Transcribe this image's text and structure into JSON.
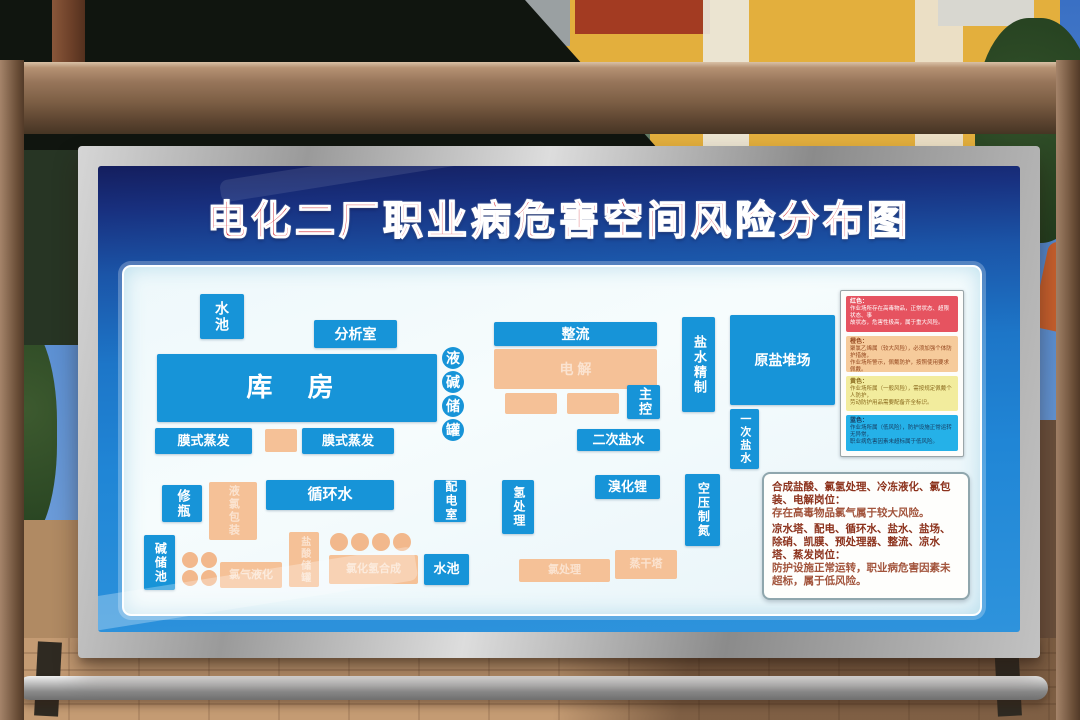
{
  "board": {
    "title": "电化二厂职业病危害空间风险分布图",
    "colors": {
      "title_red": "#cf1e28",
      "blue_box": "#1794d8",
      "orange_box": "#f5c197",
      "poster_blue": "#1d76c8"
    },
    "diagram": {
      "boxes": [
        {
          "id": "shuichi-top",
          "label": "水池",
          "kind": "blue",
          "vertical": true,
          "x": 76,
          "y": 27,
          "w": 44,
          "h": 45,
          "font": 14
        },
        {
          "id": "fenxishi",
          "label": "分析室",
          "kind": "blue",
          "x": 190,
          "y": 53,
          "w": 83,
          "h": 28,
          "font": 14
        },
        {
          "id": "kufang",
          "label": "库 房",
          "kind": "blue",
          "big": true,
          "x": 33,
          "y": 87,
          "w": 280,
          "h": 68,
          "font": 26
        },
        {
          "id": "moshizhengfa-left",
          "label": "膜式蒸发",
          "kind": "blue",
          "x": 31,
          "y": 161,
          "w": 97,
          "h": 26,
          "font": 13
        },
        {
          "id": "orange-mid",
          "label": "",
          "kind": "orange",
          "x": 141,
          "y": 162,
          "w": 32,
          "h": 23,
          "font": 10
        },
        {
          "id": "moshizhengfa-right",
          "label": "膜式蒸发",
          "kind": "blue",
          "x": 178,
          "y": 161,
          "w": 92,
          "h": 26,
          "font": 13
        },
        {
          "id": "xiuping",
          "label": "修瓶",
          "kind": "blue",
          "vertical": true,
          "x": 38,
          "y": 218,
          "w": 40,
          "h": 37,
          "font": 13
        },
        {
          "id": "yelv-baozhuang",
          "label": "液氯包装",
          "kind": "orange",
          "vertical": true,
          "faint": true,
          "x": 85,
          "y": 215,
          "w": 48,
          "h": 58,
          "font": 11
        },
        {
          "id": "xunhuanshui",
          "label": "循环水",
          "kind": "blue",
          "x": 142,
          "y": 213,
          "w": 128,
          "h": 30,
          "font": 15
        },
        {
          "id": "peidianshi",
          "label": "配电室",
          "kind": "blue",
          "vertical": true,
          "x": 310,
          "y": 213,
          "w": 32,
          "h": 42,
          "font": 12
        },
        {
          "id": "jianchuchi",
          "label": "碱储池",
          "kind": "blue",
          "vertical": true,
          "x": 20,
          "y": 268,
          "w": 31,
          "h": 55,
          "font": 12
        },
        {
          "id": "tanks-2x2",
          "label": "",
          "kind": "orange-circles",
          "x": 58,
          "y": 285,
          "w": 60,
          "h": 36,
          "rows": 2,
          "cols": 2,
          "r": 16
        },
        {
          "id": "lvqi-yehua",
          "label": "氯气液化",
          "kind": "orange",
          "faint": true,
          "x": 96,
          "y": 295,
          "w": 62,
          "h": 26,
          "font": 11
        },
        {
          "id": "yansuan-chuguan",
          "label": "盐酸储罐",
          "kind": "orange",
          "vertical": true,
          "faint": true,
          "x": 165,
          "y": 265,
          "w": 30,
          "h": 55,
          "font": 10
        },
        {
          "id": "tanks-row4",
          "label": "",
          "kind": "orange-circles",
          "x": 206,
          "y": 266,
          "w": 88,
          "h": 20,
          "rows": 1,
          "cols": 4,
          "r": 18
        },
        {
          "id": "lvhuaqing-hecheng",
          "label": "氯化氢合成",
          "kind": "orange",
          "faint": true,
          "x": 205,
          "y": 288,
          "w": 89,
          "h": 29,
          "font": 11
        },
        {
          "id": "shuichi-bottom",
          "label": "水池",
          "kind": "blue",
          "x": 300,
          "y": 287,
          "w": 45,
          "h": 31,
          "font": 13
        },
        {
          "id": "yejian-chuguan",
          "label": "液碱储罐",
          "kind": "blue-circles",
          "x": 318,
          "y": 80,
          "w": 26,
          "h": 92,
          "rows": 4,
          "cols": 1,
          "r": 22
        },
        {
          "id": "zhengliu",
          "label": "整流",
          "kind": "blue",
          "x": 370,
          "y": 55,
          "w": 163,
          "h": 24,
          "font": 14
        },
        {
          "id": "dianjie",
          "label": "电 解",
          "kind": "orange",
          "faint": true,
          "x": 370,
          "y": 82,
          "w": 163,
          "h": 40,
          "font": 14
        },
        {
          "id": "orange-a",
          "label": "",
          "kind": "orange",
          "x": 381,
          "y": 126,
          "w": 52,
          "h": 21,
          "font": 10
        },
        {
          "id": "orange-b",
          "label": "",
          "kind": "orange",
          "x": 443,
          "y": 126,
          "w": 52,
          "h": 21,
          "font": 10
        },
        {
          "id": "zhukong",
          "label": "主控",
          "kind": "blue",
          "vertical": true,
          "x": 503,
          "y": 118,
          "w": 33,
          "h": 34,
          "font": 13
        },
        {
          "id": "erci-yanshui",
          "label": "二次盐水",
          "kind": "blue",
          "x": 453,
          "y": 162,
          "w": 83,
          "h": 22,
          "font": 13
        },
        {
          "id": "qingchuli",
          "label": "氢处理",
          "kind": "blue",
          "vertical": true,
          "x": 378,
          "y": 213,
          "w": 32,
          "h": 54,
          "font": 12
        },
        {
          "id": "xiuhuali",
          "label": "溴化锂",
          "kind": "blue",
          "x": 471,
          "y": 208,
          "w": 65,
          "h": 24,
          "font": 13
        },
        {
          "id": "kongya-zhidan",
          "label": "空压制氮",
          "kind": "blue",
          "vertical": true,
          "x": 561,
          "y": 207,
          "w": 35,
          "h": 72,
          "font": 12
        },
        {
          "id": "yici-yanshui",
          "label": "一次盐水",
          "kind": "blue",
          "vertical": true,
          "x": 606,
          "y": 142,
          "w": 29,
          "h": 60,
          "font": 11
        },
        {
          "id": "yanshui-jingzhi",
          "label": "盐水精制",
          "kind": "blue",
          "vertical": true,
          "x": 558,
          "y": 50,
          "w": 33,
          "h": 95,
          "font": 13
        },
        {
          "id": "yuanyan-duichang",
          "label": "原盐堆场",
          "kind": "blue",
          "x": 606,
          "y": 48,
          "w": 105,
          "h": 90,
          "font": 14
        },
        {
          "id": "lvchuli",
          "label": "氯处理",
          "kind": "orange",
          "faint": true,
          "x": 395,
          "y": 292,
          "w": 91,
          "h": 23,
          "font": 11
        },
        {
          "id": "zhengganta",
          "label": "蒸干塔",
          "kind": "orange",
          "faint": true,
          "x": 491,
          "y": 283,
          "w": 62,
          "h": 29,
          "font": 11
        }
      ]
    },
    "legend": {
      "strips": [
        {
          "name": "red",
          "color": "#e65360",
          "text_color": "#ffffff",
          "title": "红色：",
          "lines": [
            "作业场所存在高毒物品，正常状态、超限状态、事",
            "故状态，危害性极高，属于重大风险。"
          ]
        },
        {
          "name": "orange",
          "color": "#f6cb9b",
          "text_color": "#94461e",
          "title": "橙色：",
          "lines": [
            "聚氯乙烯属（较大风险），必须加强个体防护措施，",
            "作业场所警示，佩戴防护，按照使用要求佩戴。"
          ]
        },
        {
          "name": "yellow",
          "color": "#f2ec9d",
          "text_color": "#8a6a1e",
          "title": "黄色：",
          "lines": [
            "作业场所属（一般风险），需按规定佩戴个人防护，",
            "劳动防护用品需要配备齐全标识。"
          ]
        },
        {
          "name": "blue",
          "color": "#25b1e8",
          "text_color": "#173a5e",
          "title": "蓝色：",
          "lines": [
            "作业场所属（低风险），防护设施正常运转无异常，",
            "职业病危害因素未超标属于低风险。"
          ]
        }
      ]
    },
    "info": {
      "sections": [
        {
          "head": "合成盐酸、氯氢处理、冷冻液化、氯包装、电解岗位：",
          "body": "存在高毒物品氯气属于较大风险。"
        },
        {
          "head": "凉水塔、配电、循环水、盐水、盐场、除硝、凯膜、预处理器、整流、凉水塔、蒸发岗位：",
          "body": "防护设施正常运转，职业病危害因素未超标，属于低风险。"
        }
      ]
    }
  }
}
